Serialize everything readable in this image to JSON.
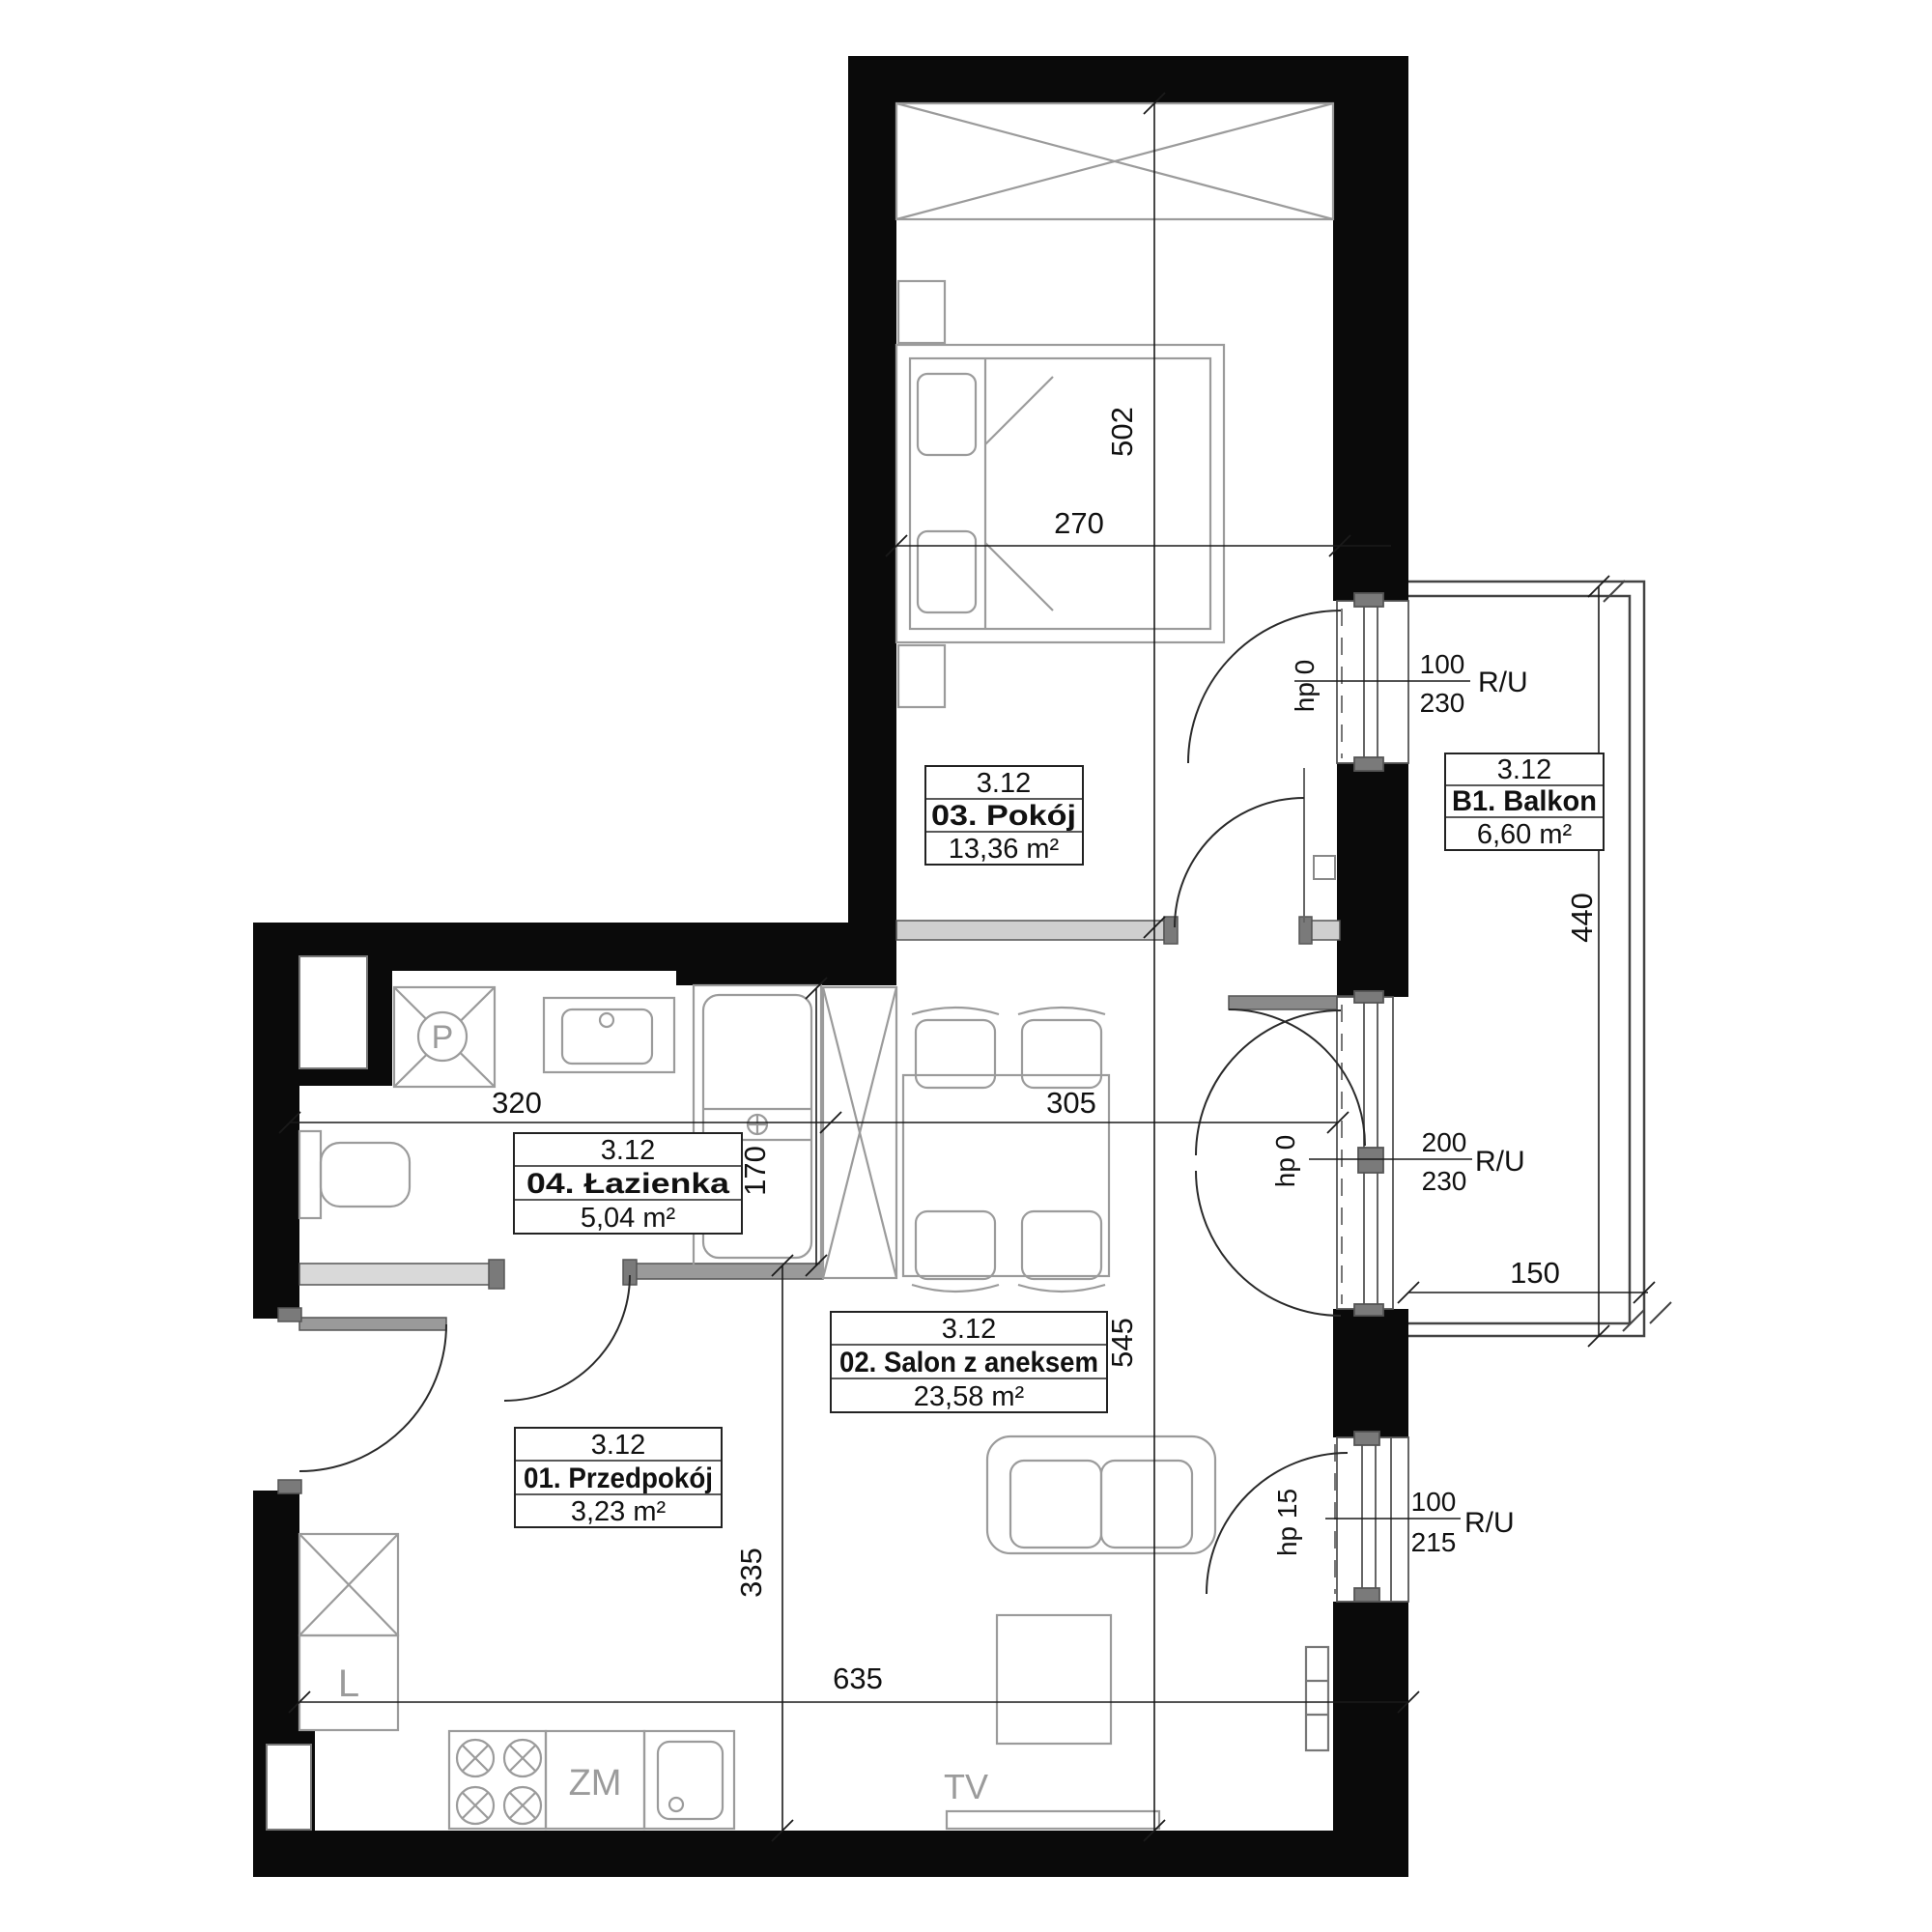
{
  "unit": "3.12",
  "rooms": {
    "przedpokoj": {
      "unit": "3.12",
      "name": "01. Przedpokój",
      "area": "3,23 m²"
    },
    "salon": {
      "unit": "3.12",
      "name": "02. Salon z aneksem",
      "area": "23,58 m²"
    },
    "pokoj": {
      "unit": "3.12",
      "name": "03. Pokój",
      "area": "13,36 m²"
    },
    "lazienka": {
      "unit": "3.12",
      "name": "04. Łazienka",
      "area": "5,04 m²"
    },
    "balkon": {
      "unit": "3.12",
      "name": "B1. Balkon",
      "area": "6,60 m²"
    }
  },
  "dimensions_cm": {
    "pokoj_depth": "502",
    "pokoj_width": "270",
    "lazienka_width": "320",
    "salon_width": "305",
    "bathtub_length": "170",
    "salon_depth": "545",
    "przedpokoj_depth": "335",
    "bottom_width": "635",
    "balkon_depth": "440",
    "balkon_width": "150"
  },
  "openings": {
    "window_top": {
      "width": "100",
      "height": "230",
      "type": "R/U",
      "sill": "hp 0"
    },
    "window_middle": {
      "width": "200",
      "height": "230",
      "type": "R/U",
      "sill": "hp 0"
    },
    "window_bottom": {
      "width": "100",
      "height": "215",
      "type": "R/U",
      "sill": "hp 15"
    }
  },
  "fixtures": {
    "shower": "P",
    "fridge": "L",
    "dishwasher": "ZM",
    "tv": "TV"
  },
  "colors": {
    "wall": "#0a0a0a",
    "partition": "#cfcfcf",
    "partition_dark": "#7a7a7a",
    "furniture": "#9b9b9b",
    "dimension": "#1a1a1a"
  }
}
